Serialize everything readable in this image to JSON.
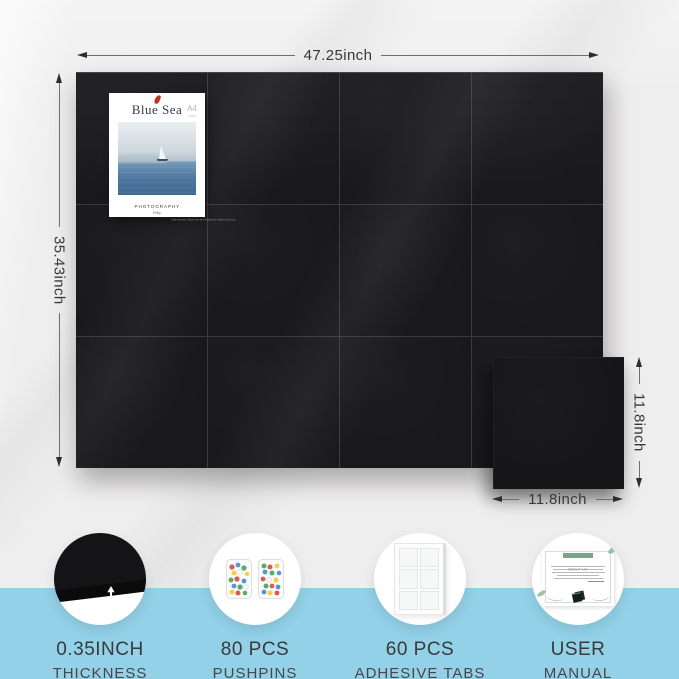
{
  "colors": {
    "background": "#efeeee",
    "felt_black": "#19191b",
    "accent_blue": "#92d1e8",
    "dimension_text": "#383838"
  },
  "dimensions": {
    "board_width": "47.25inch",
    "board_height": "35.43inch",
    "tile_height": "11.8inch",
    "tile_width": "11.8inch"
  },
  "board": {
    "columns": 4,
    "rows": 3,
    "tile_count": 12
  },
  "poster": {
    "title": "Blue Sea",
    "subtitle": "Philip & Elsa",
    "badge_top": "A4",
    "badge_bottom": "Paper",
    "caption_title": "PHOTOGRAPHY",
    "caption_author": "Philip",
    "footer": "Sea scenery  |  Blue sea and sailboat  |  Inspired by sea"
  },
  "manual": {
    "header": "ABOUT US"
  },
  "features": [
    {
      "icon": "felt-thickness-icon",
      "line1": "0.35INCH",
      "line2": "THICKNESS"
    },
    {
      "icon": "pushpins-icon",
      "line1": "80 PCS",
      "line2": "PUSHPINS"
    },
    {
      "icon": "adhesive-tabs-icon",
      "line1": "60 PCS",
      "line2": "ADHESIVE TABS"
    },
    {
      "icon": "user-manual-icon",
      "line1": "USER",
      "line2": "MANUAL"
    }
  ]
}
